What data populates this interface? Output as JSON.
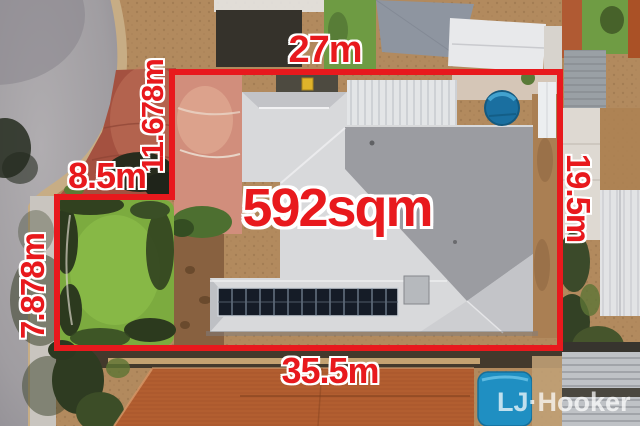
{
  "annotations": {
    "area": "592sqm",
    "dimensions": {
      "top": "27m",
      "left_upper": "11.678m",
      "left_step": "8.5m",
      "left_lower": "7.878m",
      "right": "19.5m",
      "bottom": "35.5m"
    },
    "colors": {
      "boundary_red": "#e8191d",
      "label_outline": "#ffffff"
    }
  },
  "watermark": {
    "brand": "LJ·Hooker",
    "color": "#ffffff"
  },
  "scene": {
    "description_labels": {
      "lot_shape": "rectangular lot with stepped left boundary",
      "features": [
        "road-culdesac",
        "brick-crossover",
        "footpath",
        "lawn",
        "house-hip-roof",
        "solar-panel-array",
        "round-pool-spa",
        "blue-pool-cover",
        "terracotta-neighbor-roofs",
        "shade-sail",
        "sheds"
      ]
    },
    "colors": {
      "road": "#a09da1",
      "footpath": "#c9c5bf",
      "brick_paving": "#a45140",
      "dirt": "#b28a5e",
      "lawn": "#7cab3f",
      "roof_light": "#d8d9db",
      "roof_dark": "#9b9ca1",
      "terracotta_roof": "#b25e30",
      "pool_blue": "#1f8fc2",
      "solar_panel": "#151c27"
    }
  }
}
